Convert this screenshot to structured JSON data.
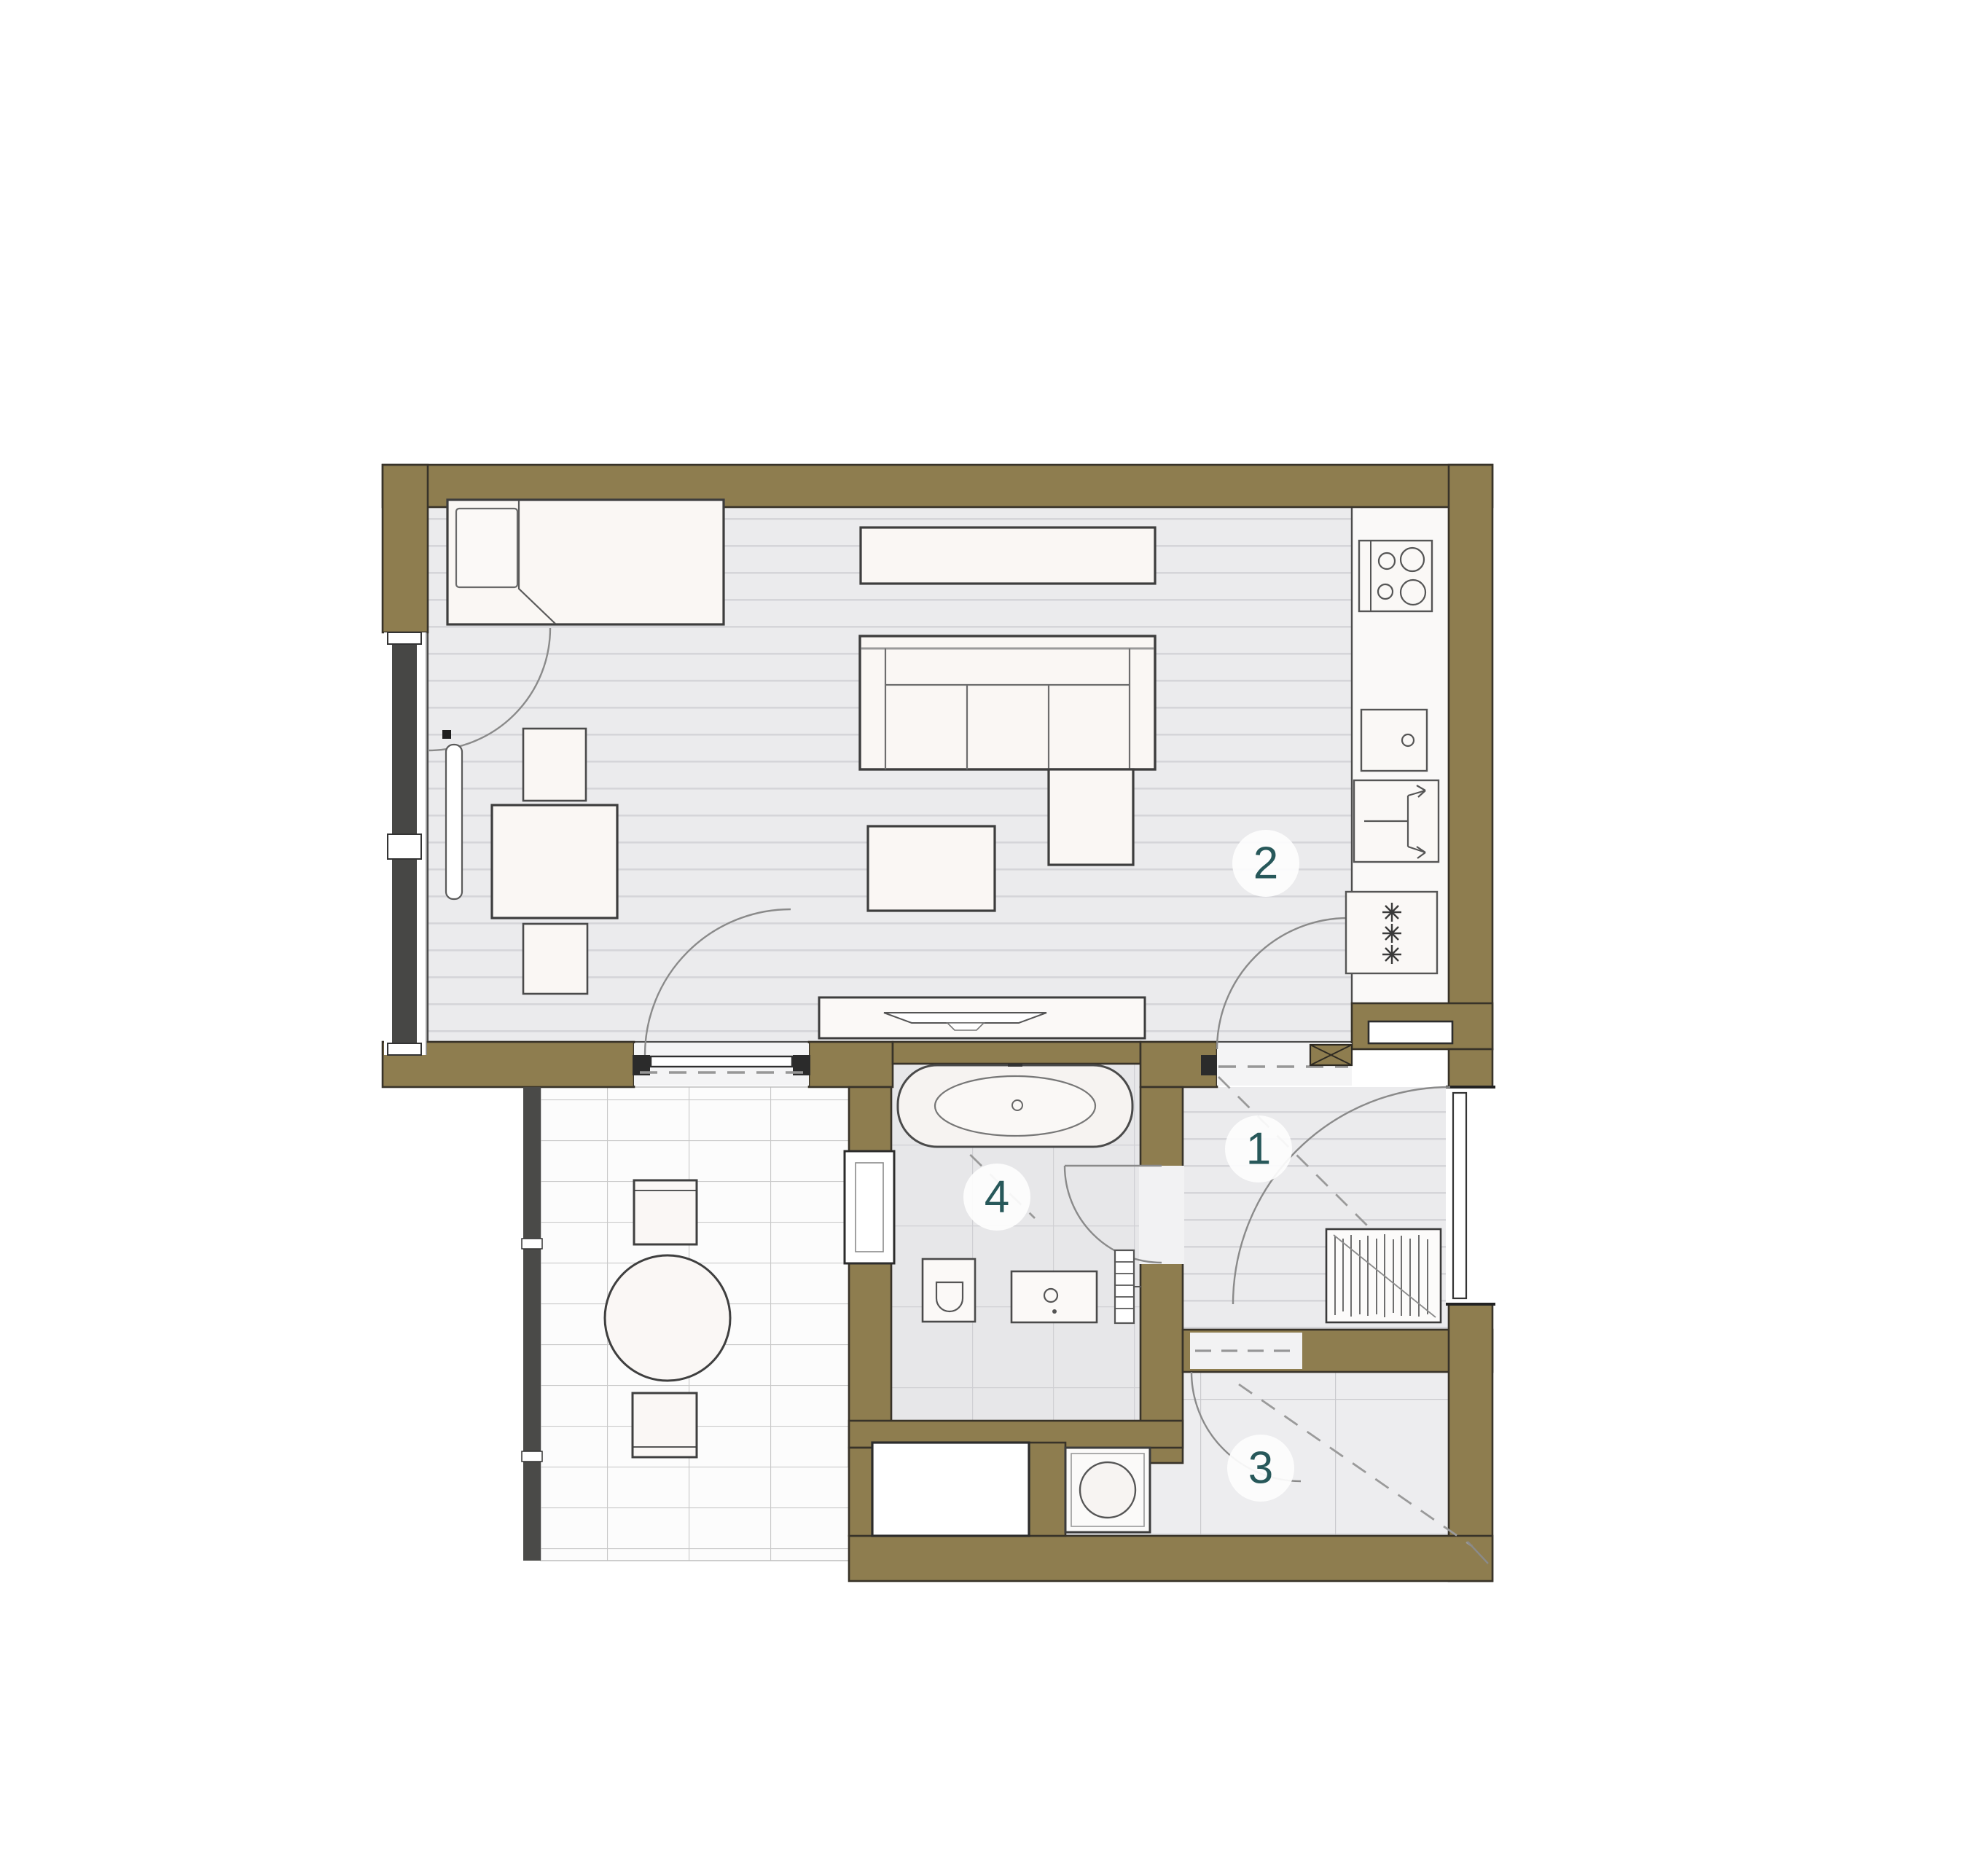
{
  "page": {
    "type": "architectural-floor-plan",
    "background": "#ffffff"
  },
  "colors": {
    "wall": "#8e7d4f",
    "wall_outline": "#383329",
    "living_floor": "#ebebed",
    "living_stripe": "#d5d5d9",
    "bath_tile_bg": "#e7e7e9",
    "bath_tile_line": "#d0d0d4",
    "balcony_bg": "#fcfcfc",
    "balcony_line": "#c9c9c9",
    "storage_bg": "#ededef",
    "storage_line": "#cacace",
    "kitchen_floor": "#faf9f8",
    "furniture_fill": "#faf7f4",
    "furniture_line": "#3f3f3f",
    "light_line": "#7a7a7a",
    "dash_line": "#979797",
    "window_dark": "#474745",
    "label_color": "#27585a",
    "badge_bg": "#fdfdfd"
  },
  "rooms": [
    {
      "number": "1",
      "name": "hallway"
    },
    {
      "number": "2",
      "name": "living-room-with-kitchen"
    },
    {
      "number": "3",
      "name": "storage-room"
    },
    {
      "number": "4",
      "name": "bathroom"
    }
  ],
  "fixtures": {
    "kitchen": [
      "hob",
      "sink",
      "dishwasher",
      "refrigerator"
    ],
    "bathroom": [
      "bathtub",
      "toilet",
      "washbasin",
      "towel-radiator",
      "window"
    ],
    "living": [
      "bed",
      "sideboard",
      "sofa-with-chaise",
      "coffee-table",
      "tv-sideboard",
      "dining-table",
      "chair",
      "chair",
      "radiator"
    ],
    "hallway": [
      "coat-rack",
      "entry-door"
    ],
    "storage": [
      "washing-machine"
    ],
    "balcony": [
      "round-table",
      "chair",
      "chair",
      "railing"
    ]
  }
}
